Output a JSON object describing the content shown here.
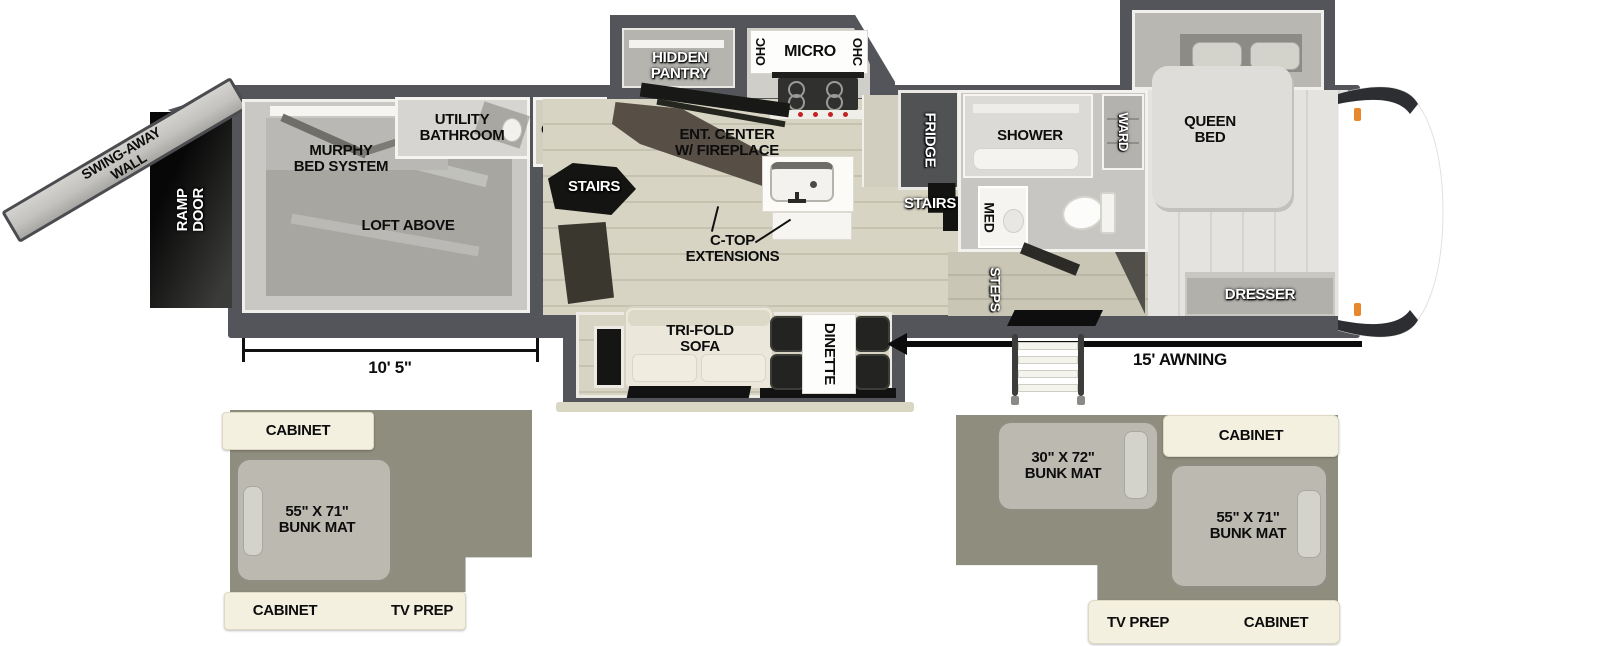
{
  "fp": {
    "exterior": {
      "swing_wall": "SWING-AWAY\nWALL",
      "ramp_door": "RAMP\nDOOR",
      "awning": "15' AWNING",
      "garage_dim": "10' 5\""
    },
    "garage": {
      "murphy": "MURPHY\nBED SYSTEM",
      "loft": "LOFT ABOVE",
      "utility_bath": "UTILITY\nBATHROOM",
      "stairs": "STAIRS"
    },
    "kitchen": {
      "cabinet": "CABINET",
      "pantry": "HIDDEN\nPANTRY",
      "ohc_left": "OHC",
      "micro": "MICRO",
      "ohc_right": "OHC",
      "ent_center": "ENT. CENTER\nW/ FIREPLACE",
      "ctop": "C-TOP\nEXTENSIONS",
      "fridge": "FRIDGE"
    },
    "living": {
      "sofa": "TRI-FOLD\nSOFA",
      "dinette": "DINETTE"
    },
    "bath": {
      "stairs": "STAIRS",
      "shower": "SHOWER",
      "med": "MED",
      "ward": "WARD",
      "steps": "STEPS"
    },
    "bedroom": {
      "queen": "QUEEN\nBED",
      "dresser": "DRESSER"
    }
  },
  "insets": {
    "left": {
      "cabinet_top": "CABINET",
      "bunk": "55\" X 71\"\nBUNK MAT",
      "cabinet_bottom": "CABINET",
      "tv_prep": "TV PREP"
    },
    "right": {
      "bunk_top": "30\" X 72\"\nBUNK MAT",
      "cabinet_top": "CABINET",
      "bunk_right": "55\" X 71\"\nBUNK MAT",
      "tv_prep": "TV PREP",
      "cabinet_bottom": "CABINET"
    }
  },
  "colors": {
    "wall": "#54555a",
    "wood_floor": "#d8d4c3",
    "bedroom_floor": "#e4e3df",
    "inset_bg": "#8f8e7e",
    "cream": "#f3f0e0",
    "marker_light": "#e8872b"
  }
}
